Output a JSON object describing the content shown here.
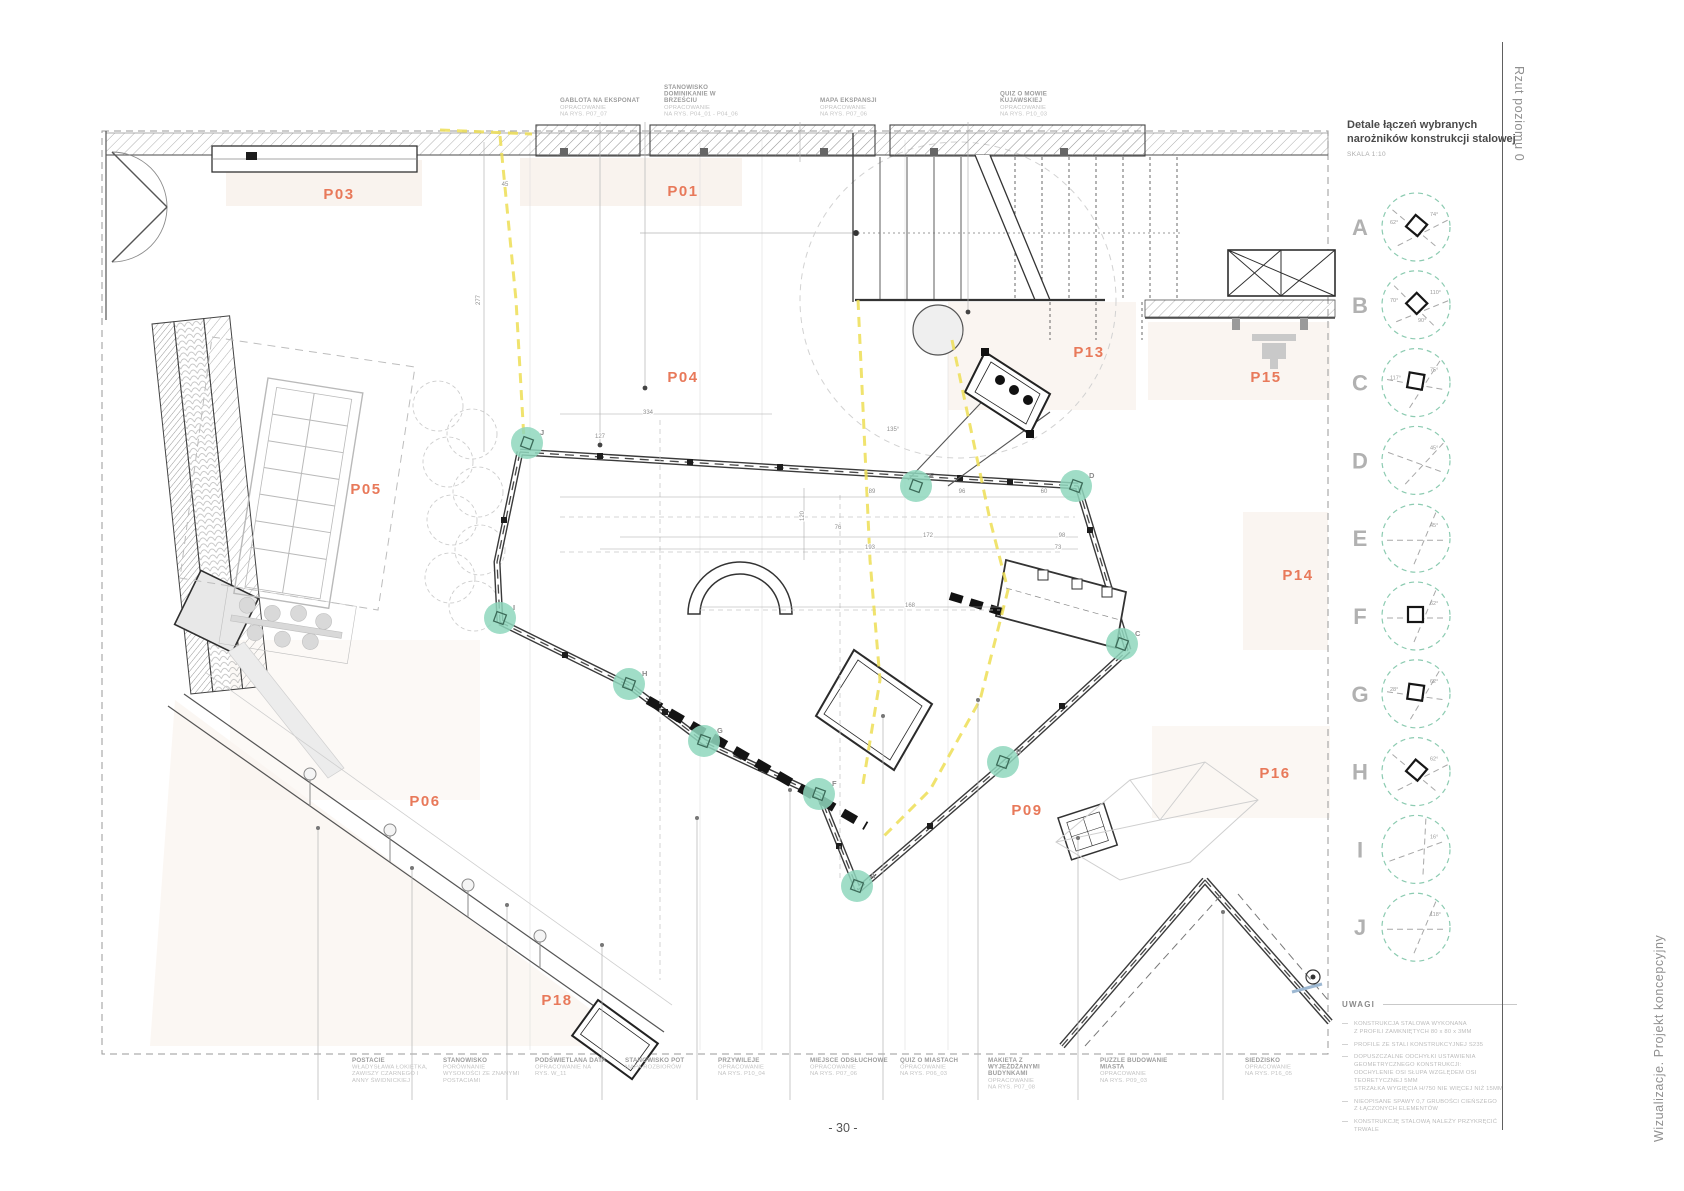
{
  "page": {
    "number": "- 30 -",
    "side_top": "Rzut poziomu 0",
    "side_bottom": "Wizualizacje. Projekt koncepcyjny"
  },
  "detail_panel": {
    "title1": "Detale łączeń wybranych",
    "title2": "narożników konstrukcji stalowej",
    "scale": "SKALA 1:10",
    "details": [
      {
        "letter": "A",
        "angles": [
          "74°",
          "62°"
        ],
        "square": true,
        "rot": 40
      },
      {
        "letter": "B",
        "angles": [
          "110°",
          "70°",
          "90°"
        ],
        "square": true,
        "rot": 45
      },
      {
        "letter": "C",
        "angles": [
          "75°",
          "117°"
        ],
        "square": true,
        "rot": 10
      },
      {
        "letter": "D",
        "angles": [
          "45°"
        ],
        "square": false,
        "rot": 20
      },
      {
        "letter": "E",
        "angles": [
          "45°"
        ],
        "square": false,
        "rot": 0
      },
      {
        "letter": "F",
        "angles": [
          "62°"
        ],
        "square": true,
        "rot": 0
      },
      {
        "letter": "G",
        "angles": [
          "62°",
          "28°"
        ],
        "square": true,
        "rot": 8
      },
      {
        "letter": "H",
        "angles": [
          "62°"
        ],
        "square": true,
        "rot": 40
      },
      {
        "letter": "I",
        "angles": [
          "16°"
        ],
        "square": false,
        "rot": -20
      },
      {
        "letter": "J",
        "angles": [
          "118°"
        ],
        "square": false,
        "rot": 0
      }
    ]
  },
  "notes": {
    "heading": "UWAGI",
    "items": [
      [
        "KONSTRUKCJA STALOWA WYKONANA",
        "Z PROFILI ZAMKNIĘTYCH 80 x 80 x 3MM"
      ],
      [
        "PROFILE ZE STALI KONSTRUKCYJNEJ S235"
      ],
      [
        "DOPUSZCZALNE ODCHYŁKI USTAWIENIA",
        "GEOMETRYCZNEGO KONSTRUKCJI:",
        "ODCHYLENIE OSI SŁUPA WZGLĘDEM OSI",
        "TEORETYCZNEJ 5MM",
        "STRZAŁKA WYGIĘCIA H/750 NIE WIĘCEJ NIŻ 15MM"
      ],
      [
        "NIEOPISANE SPAWY 0,7 GRUBOŚCI CIEŃSZEGO",
        "Z ŁĄCZONYCH ELEMENTÓW"
      ],
      [
        "KONSTRUKCJĘ STALOWĄ NALEŻY PRZYKRĘCIĆ TRWALE"
      ]
    ]
  },
  "plan": {
    "zones": [
      {
        "id": "P01",
        "x": 683,
        "y": 196
      },
      {
        "id": "P03",
        "x": 339,
        "y": 199
      },
      {
        "id": "P04",
        "x": 683,
        "y": 382
      },
      {
        "id": "P05",
        "x": 366,
        "y": 494
      },
      {
        "id": "P06",
        "x": 425,
        "y": 806
      },
      {
        "id": "P09",
        "x": 1027,
        "y": 815
      },
      {
        "id": "P13",
        "x": 1089,
        "y": 357
      },
      {
        "id": "P14",
        "x": 1298,
        "y": 580
      },
      {
        "id": "P15",
        "x": 1266,
        "y": 382
      },
      {
        "id": "P16",
        "x": 1275,
        "y": 778
      },
      {
        "id": "P18",
        "x": 557,
        "y": 1005
      }
    ],
    "markers": [
      {
        "letter": "J",
        "x": 527,
        "y": 443
      },
      {
        "letter": "I",
        "x": 500,
        "y": 618
      },
      {
        "letter": "H",
        "x": 629,
        "y": 684
      },
      {
        "letter": "G",
        "x": 704,
        "y": 741
      },
      {
        "letter": "F",
        "x": 819,
        "y": 794
      },
      {
        "letter": "A",
        "x": 857,
        "y": 886
      },
      {
        "letter": "B",
        "x": 1003,
        "y": 762
      },
      {
        "letter": "C",
        "x": 1122,
        "y": 644
      },
      {
        "letter": "D",
        "x": 1076,
        "y": 486
      },
      {
        "letter": "E",
        "x": 916,
        "y": 486
      }
    ],
    "dimensions": [
      {
        "v": "334",
        "x": 648,
        "y": 414
      },
      {
        "v": "127",
        "x": 600,
        "y": 438
      },
      {
        "v": "89",
        "x": 872,
        "y": 493
      },
      {
        "v": "96",
        "x": 962,
        "y": 493
      },
      {
        "v": "60",
        "x": 1044,
        "y": 493
      },
      {
        "v": "76",
        "x": 838,
        "y": 529
      },
      {
        "v": "172",
        "x": 928,
        "y": 537
      },
      {
        "v": "193",
        "x": 870,
        "y": 549
      },
      {
        "v": "98",
        "x": 1062,
        "y": 537
      },
      {
        "v": "73",
        "x": 1058,
        "y": 549
      },
      {
        "v": "168",
        "x": 910,
        "y": 607
      },
      {
        "v": "135°",
        "x": 893,
        "y": 431
      },
      {
        "v": "45",
        "x": 505,
        "y": 186
      },
      {
        "v": "120",
        "x": 804,
        "y": 516,
        "r": 1
      },
      {
        "v": "277",
        "x": 480,
        "y": 300,
        "r": 1
      }
    ]
  },
  "annotations_top": [
    {
      "x": 560,
      "lead_x": 600,
      "lead_y": 445,
      "dot": true,
      "title": [
        "GABLOTA NA EKSPONAT"
      ],
      "sub": [
        "OPRACOWANIE",
        "NA RYS. P07_07"
      ]
    },
    {
      "x": 664,
      "lead_x": 645,
      "lead_y": 388,
      "dot": true,
      "title": [
        "STANOWISKO",
        "DOMINIKANIE W",
        "BRZEŚCIU"
      ],
      "sub": [
        "OPRACOWANIE",
        "NA RYS. P04_01 - P04_06"
      ]
    },
    {
      "x": 820,
      "lead_x": 800,
      "lead_y": 162,
      "dot": false,
      "title": [
        "MAPA EKSPANSJI"
      ],
      "sub": [
        "OPRACOWANIE",
        "NA RYS. P07_06"
      ]
    },
    {
      "x": 1000,
      "lead_x": 968,
      "lead_y": 312,
      "dot": true,
      "title": [
        "QUIZ O MOWIE",
        "KUJAWSKIEJ"
      ],
      "sub": [
        "OPRACOWANIE",
        "NA RYS. P10_03"
      ]
    }
  ],
  "annotations_bottom": [
    {
      "x": 352,
      "lead_x": 318,
      "lead_y": 828,
      "title": [
        "POSTACIE"
      ],
      "sub": [
        "WŁADYSŁAWA ŁOKIETKA,",
        "ZAWISZY CZARNEGO I",
        "ANNY ŚWIDNICKIEJ"
      ]
    },
    {
      "x": 443,
      "lead_x": 412,
      "lead_y": 868,
      "title": [
        "STANOWISKO"
      ],
      "sub": [
        "PORÓWNANIE",
        "WYSOKOŚCI ZE ZNANYMI",
        "POSTACIAMI"
      ]
    },
    {
      "x": 535,
      "lead_x": 507,
      "lead_y": 905,
      "title": [
        "PODŚWIETLANA DATA"
      ],
      "sub": [
        "OPRACOWANIE NA",
        "RYS. W_11"
      ]
    },
    {
      "x": 625,
      "lead_x": 602,
      "lead_y": 945,
      "title": [
        "STANOWISKO POT"
      ],
      "sub": [
        "MAPA ROZBIORÓW"
      ]
    },
    {
      "x": 718,
      "lead_x": 697,
      "lead_y": 818,
      "title": [
        "PRZYWILEJE"
      ],
      "sub": [
        "OPRACOWANIE",
        "NA RYS. P10_04"
      ]
    },
    {
      "x": 810,
      "lead_x": 790,
      "lead_y": 790,
      "title": [
        "MIEJSCE ODSŁUCHOWE"
      ],
      "sub": [
        "OPRACOWANIE",
        "NA RYS. P07_06"
      ]
    },
    {
      "x": 900,
      "lead_x": 883,
      "lead_y": 716,
      "title": [
        "QUIZ O MIASTACH"
      ],
      "sub": [
        "OPRACOWANIE",
        "NA RYS. P06_03"
      ]
    },
    {
      "x": 988,
      "lead_x": 978,
      "lead_y": 700,
      "title": [
        "MAKIETA Z",
        "WYJEŻDŻANYMI",
        "BUDYNKAMI"
      ],
      "sub": [
        "OPRACOWANIE",
        "NA RYS. P07_08"
      ]
    },
    {
      "x": 1100,
      "lead_x": 1078,
      "lead_y": 838,
      "title": [
        "PUZZLE BUDOWANIE",
        "MIASTA"
      ],
      "sub": [
        "OPRACOWANIE",
        "NA RYS. P09_03"
      ]
    },
    {
      "x": 1245,
      "lead_x": 1223,
      "lead_y": 912,
      "title": [
        "SIEDZISKO"
      ],
      "sub": [
        "OPRACOWANIE",
        "NA RYS. P16_05"
      ]
    }
  ],
  "colors": {
    "zone_label": "#E8795A",
    "marker_fill": "#8FD7BD",
    "detail_circle": "#8CCBB1",
    "cable": "#EDDE55",
    "tint": "#F3E7DD"
  }
}
